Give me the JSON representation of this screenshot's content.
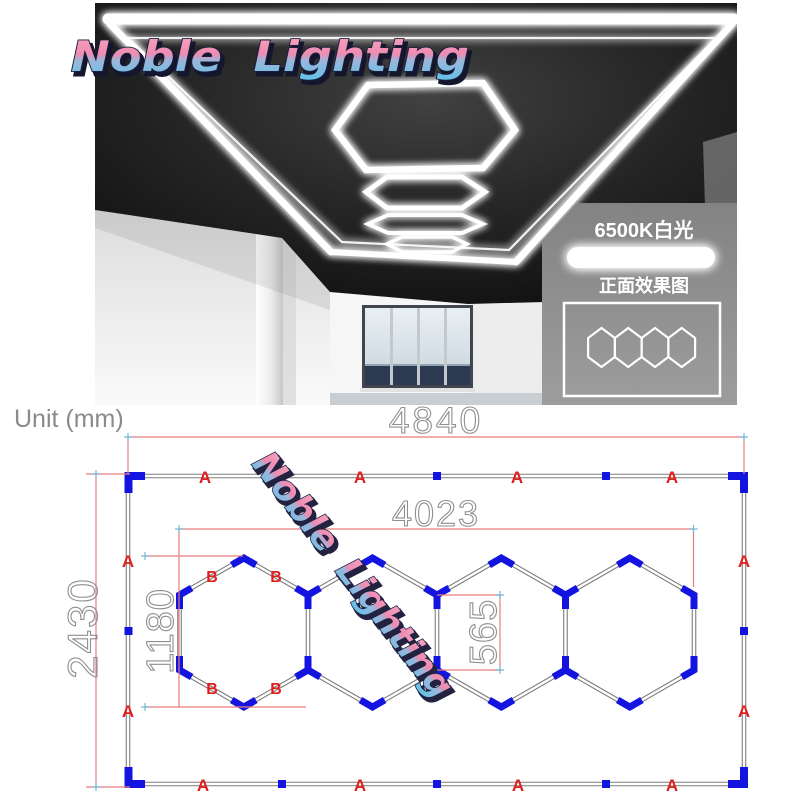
{
  "logo": {
    "text": "Noble Lighting",
    "pink": "#f293b6",
    "blue": "#64c3e8"
  },
  "watermark": {
    "text": "Noble Lighting"
  },
  "panel": {
    "color_temp": "6500K白光",
    "front_view": "正面效果图"
  },
  "diagram": {
    "unit": "Unit (mm)",
    "dim_overall_width": "4840",
    "dim_overall_height": "2430",
    "dim_inner_width": "4023",
    "dim_hex_height": "1180",
    "dim_hex_side": "565",
    "label_a": "A",
    "label_b": "B",
    "colors": {
      "dimension_line": "#e87c7c",
      "label_red": "#e02020",
      "connector_blue": "#1414e0",
      "frame_gray": "#7d7d7d",
      "led_white": "#ffffff",
      "ceiling_black": "#161616",
      "panel_gray": "#8a8a8a"
    }
  }
}
